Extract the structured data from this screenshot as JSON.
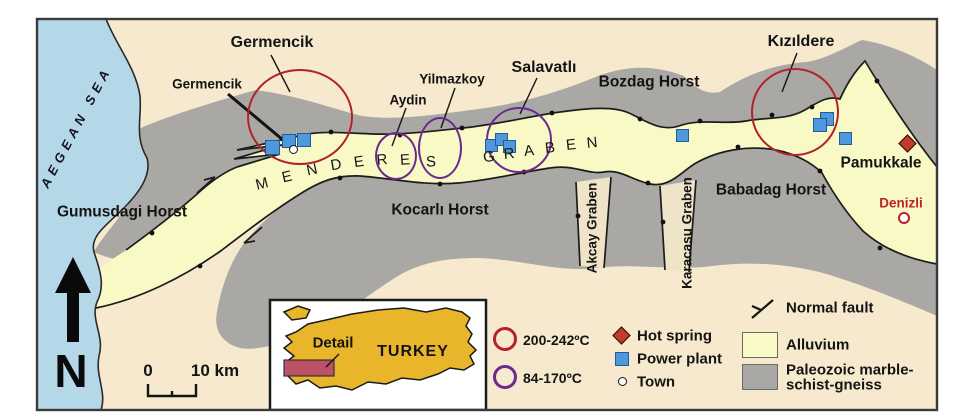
{
  "figure": {
    "type": "geological sketch map",
    "area": "Menderes Graben, western Turkey"
  },
  "north_label": "N",
  "scale_bar": {
    "zero": "0",
    "label": "10 km"
  },
  "inset": {
    "detail_label": "Detail",
    "country_label": "TURKEY"
  },
  "legend": {
    "high_temp_label": "200-242ºC",
    "low_temp_label": "84-170ºC",
    "hot_spring_label": "Hot spring",
    "power_plant_label": "Power plant",
    "town_label": "Town",
    "normal_fault_label": "Normal fault",
    "alluvium_label": "Alluvium",
    "paleozoic_label_line1": "Paleozoic marble-",
    "paleozoic_label_line2": "schist-gneiss"
  },
  "colors": {
    "sea": "#b5d8e9",
    "background": "#f6e9cd",
    "alluvium": "#f8f9c5",
    "paleozoic": "#a9a8a5",
    "high_temp_ring": "#b2222a",
    "low_temp_ring": "#6b2a8f",
    "power_plant": "#4f98db",
    "hot_spring": "#c23b28",
    "denizli_text": "#c0202a",
    "turkey_fill": "#e9b62b",
    "detail_rect": "#bb5266"
  },
  "map": {
    "labels": [
      {
        "n": "sea-label",
        "t": "AEGEAN SEA",
        "x": 76,
        "y": 127,
        "fs": 13,
        "fw": 700,
        "r": -62,
        "ls": 5,
        "i": true,
        "c": "#14141c"
      },
      {
        "n": "label-gumusdagi-horst",
        "t": "Gumusdagi Horst",
        "x": 122,
        "y": 212,
        "fs": 15.5
      },
      {
        "n": "label-kocarli-horst",
        "t": "Kocarlı Horst",
        "x": 440,
        "y": 210,
        "fs": 15.5
      },
      {
        "n": "label-babadag-horst",
        "t": "Babadag Horst",
        "x": 771,
        "y": 190,
        "fs": 15.5
      },
      {
        "n": "label-bozdag-horst",
        "t": "Bozdag Horst",
        "x": 649,
        "y": 82,
        "fs": 15.5
      },
      {
        "n": "label-germencik-field",
        "t": "Germencik",
        "x": 272,
        "y": 43,
        "fs": 16
      },
      {
        "n": "label-germencik-town",
        "t": "Germencik",
        "x": 207,
        "y": 84,
        "fs": 13.5
      },
      {
        "n": "label-aydin",
        "t": "Aydin",
        "x": 408,
        "y": 100,
        "fs": 13.5
      },
      {
        "n": "label-yilmazkoy",
        "t": "Yilmazkoy",
        "x": 452,
        "y": 79,
        "fs": 13.5
      },
      {
        "n": "label-salavatli",
        "t": "Salavatlı",
        "x": 544,
        "y": 68,
        "fs": 16
      },
      {
        "n": "label-kizildere",
        "t": "Kızıldere",
        "x": 801,
        "y": 42,
        "fs": 16
      },
      {
        "n": "label-pamukkale",
        "t": "Pamukkale",
        "x": 881,
        "y": 163,
        "fs": 15.5
      },
      {
        "n": "label-denizli",
        "t": "Denizli",
        "x": 901,
        "y": 203,
        "fs": 13.5,
        "c": "#c0202a"
      },
      {
        "n": "label-akcay-graben",
        "t": "Akcay Graben",
        "x": 592,
        "y": 228,
        "fs": 13.5,
        "r": -90
      },
      {
        "n": "label-karacasu-graben",
        "t": "Karacasu Graben",
        "x": 687,
        "y": 233,
        "fs": 13.5,
        "r": -90
      },
      {
        "n": "graben-letter",
        "t": "M",
        "x": 262,
        "y": 184,
        "fs": 15,
        "fw": 400,
        "r": -14
      },
      {
        "n": "graben-letter",
        "t": "E",
        "x": 287,
        "y": 177,
        "fs": 15,
        "fw": 400,
        "r": -13
      },
      {
        "n": "graben-letter",
        "t": "N",
        "x": 312,
        "y": 170,
        "fs": 15,
        "fw": 400,
        "r": -12
      },
      {
        "n": "graben-letter",
        "t": "D",
        "x": 336,
        "y": 165,
        "fs": 15,
        "fw": 400,
        "r": -10
      },
      {
        "n": "graben-letter",
        "t": "E",
        "x": 359,
        "y": 162,
        "fs": 15,
        "fw": 400,
        "r": -8
      },
      {
        "n": "graben-letter",
        "t": "R",
        "x": 382,
        "y": 160,
        "fs": 15,
        "fw": 400,
        "r": -6
      },
      {
        "n": "graben-letter",
        "t": "E",
        "x": 405,
        "y": 160,
        "fs": 15,
        "fw": 400,
        "r": -4
      },
      {
        "n": "graben-letter",
        "t": "S",
        "x": 431,
        "y": 162,
        "fs": 15,
        "fw": 400,
        "r": -2
      },
      {
        "n": "graben-letter",
        "t": "G",
        "x": 489,
        "y": 157,
        "fs": 15,
        "fw": 400,
        "r": -6
      },
      {
        "n": "graben-letter",
        "t": "R",
        "x": 509,
        "y": 154,
        "fs": 15,
        "fw": 400,
        "r": -6
      },
      {
        "n": "graben-letter",
        "t": "A",
        "x": 529,
        "y": 151,
        "fs": 15,
        "fw": 400,
        "r": -6
      },
      {
        "n": "graben-letter",
        "t": "B",
        "x": 550,
        "y": 148,
        "fs": 15,
        "fw": 400,
        "r": -6
      },
      {
        "n": "graben-letter",
        "t": "E",
        "x": 571,
        "y": 145,
        "fs": 15,
        "fw": 400,
        "r": -6
      },
      {
        "n": "graben-letter",
        "t": "N",
        "x": 592,
        "y": 143,
        "fs": 15,
        "fw": 400,
        "r": -6
      }
    ],
    "power_plants": [
      {
        "x": 265,
        "y": 140,
        "s": 15
      },
      {
        "x": 282,
        "y": 134,
        "s": 14
      },
      {
        "x": 297,
        "y": 133,
        "s": 14
      },
      {
        "x": 485,
        "y": 139,
        "s": 13
      },
      {
        "x": 495,
        "y": 133,
        "s": 13
      },
      {
        "x": 503,
        "y": 140,
        "s": 13
      },
      {
        "x": 676,
        "y": 129,
        "s": 13
      },
      {
        "x": 820,
        "y": 112,
        "s": 14
      },
      {
        "x": 813,
        "y": 118,
        "s": 14
      },
      {
        "x": 839,
        "y": 132,
        "s": 13
      }
    ],
    "towns": [
      {
        "x": 289,
        "y": 145,
        "s": 9
      },
      {
        "x": 898,
        "y": 212,
        "s": 12,
        "red": true
      }
    ],
    "hot_springs": [
      {
        "x": 901,
        "y": 137,
        "s": 13
      }
    ],
    "ellipses": [
      {
        "x": 247,
        "y": 69,
        "w": 106,
        "h": 96,
        "k": "high",
        "n": "germencik-temp-ring"
      },
      {
        "x": 751,
        "y": 68,
        "w": 88,
        "h": 88,
        "k": "high",
        "n": "kizildere-temp-ring"
      },
      {
        "x": 375,
        "y": 132,
        "w": 42,
        "h": 48,
        "k": "low",
        "n": "aydin-temp-ring"
      },
      {
        "x": 418,
        "y": 117,
        "w": 44,
        "h": 62,
        "k": "low",
        "n": "yilmazkoy-temp-ring"
      },
      {
        "x": 486,
        "y": 107,
        "w": 66,
        "h": 66,
        "k": "low",
        "n": "salavatli-temp-ring"
      }
    ],
    "leaders": [
      {
        "x1": 271,
        "y1": 55,
        "x2": 290,
        "y2": 92
      },
      {
        "x1": 228,
        "y1": 94,
        "x2": 283,
        "y2": 140,
        "w": 3
      },
      {
        "x1": 406,
        "y1": 108,
        "x2": 392,
        "y2": 146
      },
      {
        "x1": 455,
        "y1": 88,
        "x2": 441,
        "y2": 128
      },
      {
        "x1": 537,
        "y1": 78,
        "x2": 520,
        "y2": 114
      },
      {
        "x1": 797,
        "y1": 53,
        "x2": 782,
        "y2": 92
      },
      {
        "x1": 339,
        "y1": 354,
        "x2": 326,
        "y2": 367
      }
    ]
  }
}
